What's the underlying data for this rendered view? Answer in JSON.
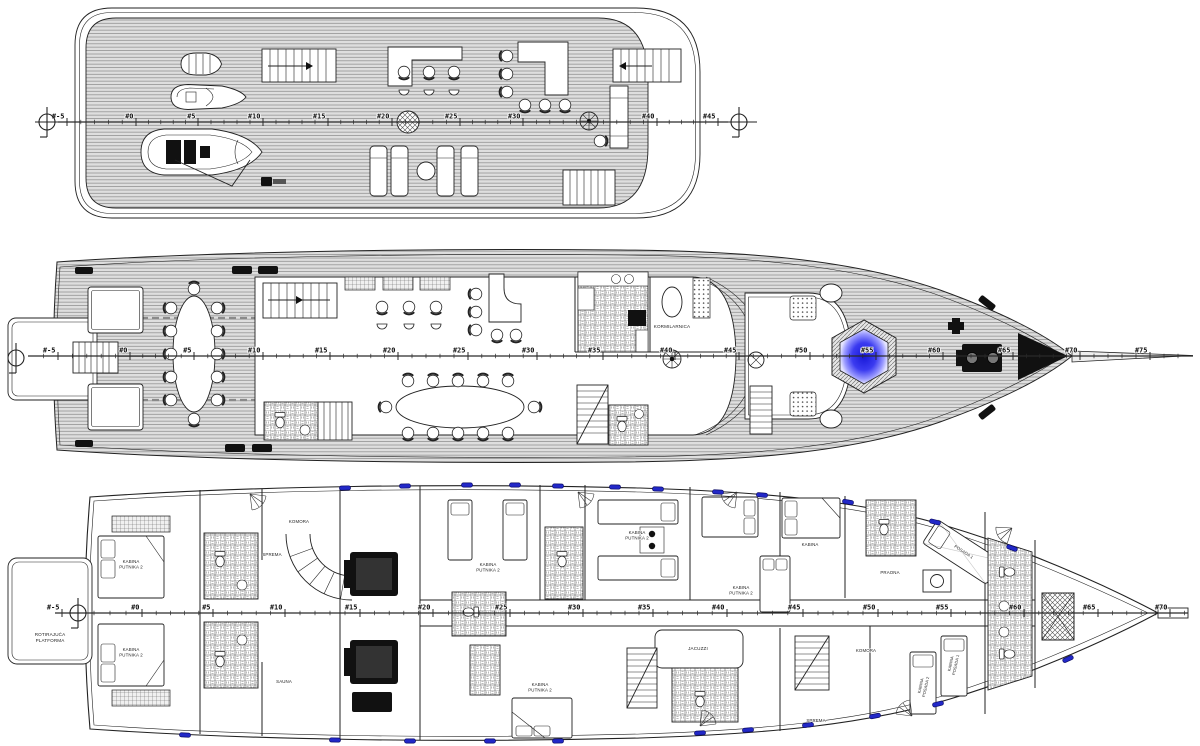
{
  "drawing": {
    "kind": "ship general arrangement plan",
    "deck_count": 3
  },
  "colors": {
    "paper": "#ffffff",
    "line": "#222222",
    "plank_base": "#dedede",
    "plank_line": "#949494",
    "jacuzzi_center": "#1818d8",
    "jacuzzi_mid": "#3b3bf0",
    "jacuzzi_edge": "#e4e4ff",
    "porthole_blue": "#2228c8"
  },
  "decks": {
    "sun": {
      "ruler": {
        "y": 122,
        "x0": 58,
        "x1": 728,
        "frames": [
          {
            "t": "#-5",
            "x": 67
          },
          {
            "t": "#0",
            "x": 136
          },
          {
            "t": "#5",
            "x": 198
          },
          {
            "t": "#10",
            "x": 263
          },
          {
            "t": "#15",
            "x": 328
          },
          {
            "t": "#20",
            "x": 392
          },
          {
            "t": "#25",
            "x": 460
          },
          {
            "t": "#30",
            "x": 523
          },
          {
            "t": "#40",
            "x": 657
          },
          {
            "t": "#45",
            "x": 718
          }
        ]
      },
      "labels": []
    },
    "main": {
      "ruler": {
        "y": 356,
        "x0": 28,
        "x1": 1193,
        "frames": [
          {
            "t": "#-5",
            "x": 58
          },
          {
            "t": "#0",
            "x": 130
          },
          {
            "t": "#5",
            "x": 194
          },
          {
            "t": "#10",
            "x": 263
          },
          {
            "t": "#15",
            "x": 330
          },
          {
            "t": "#20",
            "x": 398
          },
          {
            "t": "#25",
            "x": 468
          },
          {
            "t": "#30",
            "x": 537
          },
          {
            "t": "#35",
            "x": 603
          },
          {
            "t": "#40",
            "x": 675
          },
          {
            "t": "#45",
            "x": 739
          },
          {
            "t": "#50",
            "x": 810
          },
          {
            "t": "#55",
            "x": 876
          },
          {
            "t": "#60",
            "x": 943
          },
          {
            "t": "#65",
            "x": 1013
          },
          {
            "t": "#70",
            "x": 1080
          },
          {
            "t": "#75",
            "x": 1150
          }
        ]
      },
      "labels": [
        {
          "t": "KORMILARNICA",
          "x": 672,
          "y": 328,
          "s": 4.6
        }
      ]
    },
    "lower": {
      "ruler": {
        "y": 613,
        "x0": 55,
        "x1": 1188,
        "frames": [
          {
            "t": "#-5",
            "x": 62
          },
          {
            "t": "#0",
            "x": 142
          },
          {
            "t": "#5",
            "x": 213
          },
          {
            "t": "#10",
            "x": 285
          },
          {
            "t": "#15",
            "x": 360
          },
          {
            "t": "#20",
            "x": 433
          },
          {
            "t": "#25",
            "x": 510
          },
          {
            "t": "#30",
            "x": 583
          },
          {
            "t": "#35",
            "x": 653
          },
          {
            "t": "#40",
            "x": 727
          },
          {
            "t": "#45",
            "x": 803
          },
          {
            "t": "#50",
            "x": 878
          },
          {
            "t": "#55",
            "x": 951
          },
          {
            "t": "#60",
            "x": 1024
          },
          {
            "t": "#65",
            "x": 1098
          },
          {
            "t": "#70",
            "x": 1170
          }
        ]
      },
      "labels": [
        {
          "t": "ROTIRAJUĆA\nPLATFORMA",
          "x": 50,
          "y": 636,
          "s": 4.6
        },
        {
          "t": "KABINA\nPUTNIKA 2",
          "x": 131,
          "y": 563,
          "s": 4.4
        },
        {
          "t": "KABINA\nPUTNIKA 2",
          "x": 131,
          "y": 651,
          "s": 4.4
        },
        {
          "t": "KOMORA",
          "x": 299,
          "y": 523,
          "s": 4.4
        },
        {
          "t": "SPREMA",
          "x": 272,
          "y": 556,
          "s": 4.4
        },
        {
          "t": "SAUNA",
          "x": 284,
          "y": 683,
          "s": 4.4
        },
        {
          "t": "KABINA\nPUTNIKA 2",
          "x": 488,
          "y": 566,
          "s": 4.4
        },
        {
          "t": "KABINA\nPUTNIKA 2",
          "x": 637,
          "y": 534,
          "s": 4.4
        },
        {
          "t": "KABINA\nPUTNIKA 2",
          "x": 741,
          "y": 589,
          "s": 4.4
        },
        {
          "t": "KABINA\nPUTNIKA 2",
          "x": 540,
          "y": 686,
          "s": 4.4
        },
        {
          "t": "JACUZZI",
          "x": 698,
          "y": 650,
          "s": 4.6
        },
        {
          "t": "KABINA",
          "x": 810,
          "y": 546,
          "s": 4.4
        },
        {
          "t": "PRAONA",
          "x": 890,
          "y": 574,
          "s": 4.4
        },
        {
          "t": "KOMORA",
          "x": 866,
          "y": 652,
          "s": 4.4
        },
        {
          "t": "SPREMA",
          "x": 816,
          "y": 722,
          "s": 4.4
        },
        {
          "t": "POSADA 1",
          "x": 963,
          "y": 553,
          "s": 4.2,
          "r": 33
        },
        {
          "t": "KABINA\nPOSADA 1",
          "x": 952,
          "y": 664,
          "s": 4.0,
          "r": -78
        },
        {
          "t": "KABINA\nPOSADA 2",
          "x": 922,
          "y": 686,
          "s": 4.0,
          "r": -78
        }
      ]
    }
  }
}
